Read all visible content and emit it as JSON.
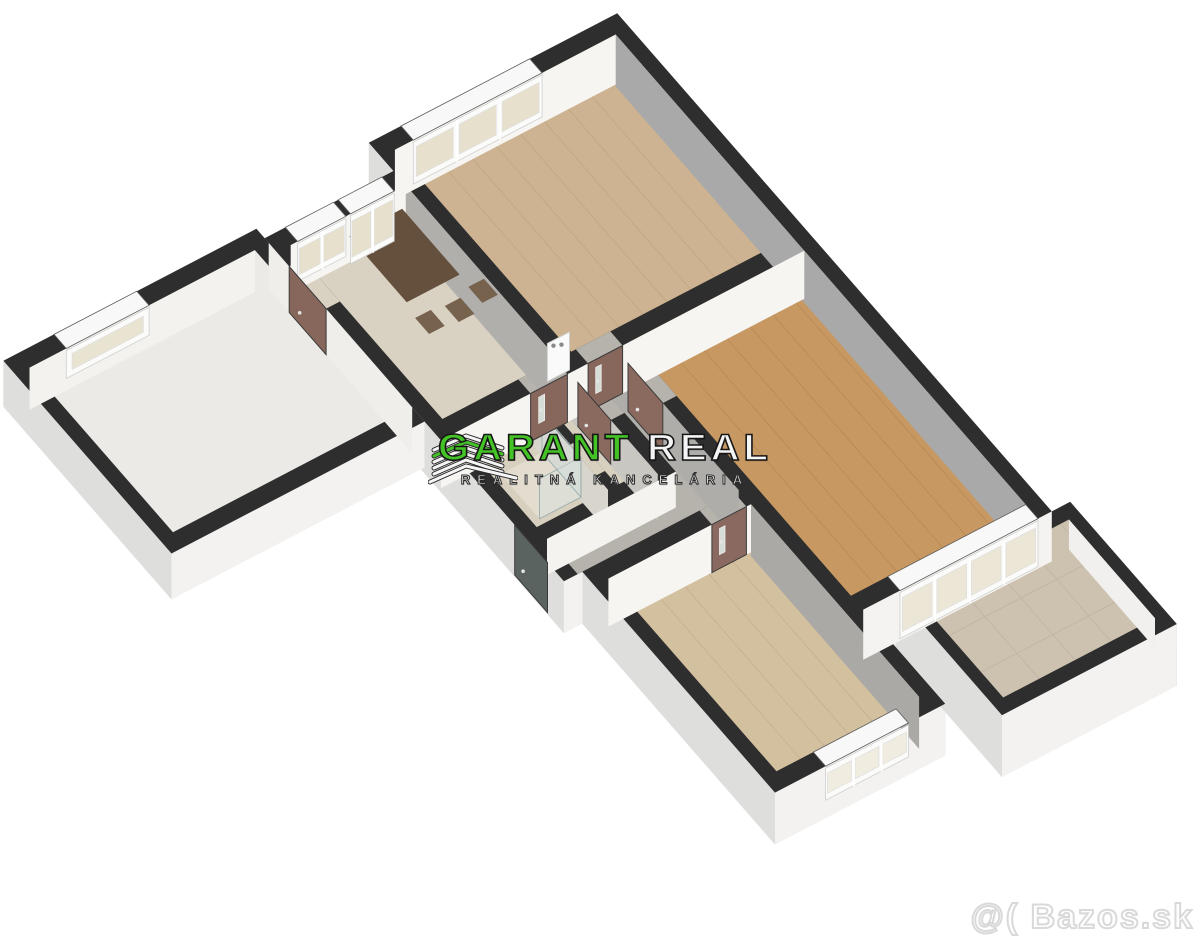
{
  "watermarks": {
    "logo_main": "GARANT",
    "logo_accent": "REAL",
    "logo_subtitle": "REALITNÁ KANCELÁRIA",
    "logo_green": "#44c327",
    "logo_white": "#f4f4f4",
    "portal_watermark": "@( Bazos.sk",
    "portal_watermark_color": "#d9d9d9"
  },
  "scene": {
    "type": "3d-floorplan-render",
    "background": "#ffffff",
    "rooms_semantic": [
      "loggia",
      "kitchen-dining",
      "bedroom-top",
      "living-room",
      "hallway",
      "bathroom",
      "wc",
      "bedroom-bottom",
      "balcony"
    ]
  },
  "plan": {
    "axon": {
      "ux": 46,
      "uy": -24,
      "vx": 41,
      "vy": 47,
      "ox": 240,
      "oy": 210,
      "wallH": 52
    },
    "colors": {
      "wall": "#2e2e2e",
      "bg": "#ffffff",
      "skirtDown": "#f3f2f0",
      "skirtLeft": "#dededd",
      "skirtRight": "#c6c6c6",
      "skirtUp": "#e9e9e8",
      "faceWhite": "#f6f5f2",
      "faceGray": "#a9a9a9"
    },
    "silhouettes": [
      {
        "name": "main-block",
        "h": 52,
        "pts": [
          [
            2.8,
            0
          ],
          [
            8.2,
            0
          ],
          [
            8.2,
            10.6
          ],
          [
            4.1,
            10.6
          ],
          [
            4.1,
            12.6
          ],
          [
            0.4,
            12.6
          ],
          [
            0.4,
            7.9
          ],
          [
            0,
            7.9
          ],
          [
            0,
            0.6
          ],
          [
            2.8,
            0.6
          ]
        ]
      },
      {
        "name": "loggia",
        "h": 46,
        "pts": [
          [
            -5.5,
            0.4
          ],
          [
            0,
            0.4
          ],
          [
            0,
            4.5
          ],
          [
            -5.5,
            4.5
          ]
        ]
      },
      {
        "name": "balcony",
        "h": 62,
        "pts": [
          [
            4.8,
            10.6
          ],
          [
            8.6,
            10.6
          ],
          [
            8.6,
            13.2
          ],
          [
            4.8,
            13.2
          ]
        ]
      }
    ],
    "floors": [
      {
        "name": "loggia-floor",
        "pts": [
          [
            -5.2,
            0.7
          ],
          [
            -0.3,
            0.7
          ],
          [
            -0.3,
            4.2
          ],
          [
            -5.2,
            4.2
          ]
        ],
        "fill": "#eceae6"
      },
      {
        "name": "kitchen-floor",
        "pts": [
          [
            0.3,
            0.9
          ],
          [
            2.8,
            0.9
          ],
          [
            2.8,
            4.6
          ],
          [
            0.3,
            4.6
          ]
        ],
        "fill": "#d9d1c2"
      },
      {
        "name": "bedroom-top-floor",
        "pts": [
          [
            3.1,
            0.3
          ],
          [
            7.9,
            0.3
          ],
          [
            7.9,
            4.6
          ],
          [
            3.1,
            4.6
          ]
        ],
        "fill": "#cdb391",
        "stripe": {
          "dir": "y",
          "gap": 0.52,
          "color": "#c2a884"
        }
      },
      {
        "name": "living-floor",
        "pts": [
          [
            4.1,
            4.9
          ],
          [
            7.9,
            4.9
          ],
          [
            7.9,
            10.3
          ],
          [
            4.1,
            10.3
          ]
        ],
        "fill": "#c79862",
        "stripe": {
          "dir": "y",
          "gap": 0.5,
          "color": "#bb8c55"
        }
      },
      {
        "name": "hall-floor",
        "pts": [
          [
            3.1,
            4.9
          ],
          [
            3.8,
            4.9
          ],
          [
            3.8,
            7.9
          ],
          [
            0.3,
            7.9
          ],
          [
            0.3,
            7.15
          ],
          [
            3.1,
            7.15
          ]
        ],
        "fill": "#b6b3ac"
      },
      {
        "name": "bathroom-floor",
        "pts": [
          [
            0.3,
            4.9
          ],
          [
            1.85,
            4.9
          ],
          [
            1.85,
            6.9
          ],
          [
            0.3,
            6.9
          ]
        ],
        "fill": "#d8d0bf"
      },
      {
        "name": "wc-floor",
        "pts": [
          [
            2.05,
            4.9
          ],
          [
            2.8,
            4.9
          ],
          [
            2.8,
            6.9
          ],
          [
            2.05,
            6.9
          ]
        ],
        "fill": "#d8d0bf"
      },
      {
        "name": "bedroom-bottom-floor",
        "pts": [
          [
            0.7,
            8.2
          ],
          [
            3.8,
            8.2
          ],
          [
            3.8,
            12.3
          ],
          [
            0.7,
            12.3
          ]
        ],
        "fill": "#d3c09e",
        "stripe": {
          "dir": "y",
          "gap": 0.52,
          "color": "#c8b391"
        }
      },
      {
        "name": "balcony-floor",
        "pts": [
          [
            5.05,
            10.85
          ],
          [
            8.35,
            10.85
          ],
          [
            8.35,
            12.95
          ],
          [
            5.05,
            12.95
          ]
        ],
        "fill": "#cdc2b0",
        "stripe": {
          "dir": "grid",
          "gap": 0.78,
          "color": "#c1b6a3"
        }
      }
    ],
    "bridges": [
      {
        "name": "kitchen-door-opening",
        "pts": [
          [
            1.95,
            4.6
          ],
          [
            2.75,
            4.6
          ],
          [
            2.75,
            4.9
          ],
          [
            1.95,
            4.9
          ]
        ],
        "fill": "#b6b3ac"
      },
      {
        "name": "bedroom-top-door-opening",
        "pts": [
          [
            3.2,
            4.6
          ],
          [
            3.95,
            4.6
          ],
          [
            3.95,
            4.9
          ],
          [
            3.2,
            4.9
          ]
        ],
        "fill": "#b6b3ac"
      },
      {
        "name": "living-door-opening",
        "pts": [
          [
            3.8,
            5.2
          ],
          [
            4.1,
            5.2
          ],
          [
            4.1,
            6.05
          ],
          [
            3.8,
            6.05
          ]
        ],
        "fill": "#b6b3ac"
      },
      {
        "name": "wc-door-opening",
        "pts": [
          [
            2.8,
            5.1
          ],
          [
            3.1,
            5.1
          ],
          [
            3.1,
            5.9
          ],
          [
            2.8,
            5.9
          ]
        ],
        "fill": "#b6b3ac"
      },
      {
        "name": "bath-door-opening",
        "pts": [
          [
            1.85,
            5.95
          ],
          [
            2.05,
            5.95
          ],
          [
            2.05,
            6.6
          ],
          [
            1.85,
            6.6
          ]
        ],
        "fill": "#d8d0bf"
      },
      {
        "name": "bedroom-bottom-door-opening",
        "pts": [
          [
            2.95,
            7.9
          ],
          [
            3.7,
            7.9
          ],
          [
            3.7,
            8.2
          ],
          [
            2.95,
            8.2
          ]
        ],
        "fill": "#b6b3ac"
      },
      {
        "name": "loggia-door-opening",
        "pts": [
          [
            -0.3,
            1.2
          ],
          [
            0.3,
            1.2
          ],
          [
            0.3,
            2.1
          ],
          [
            -0.3,
            2.1
          ]
        ],
        "fill": "#d9d1c2"
      }
    ],
    "faces": [
      {
        "a": [
          7.9,
          0.3
        ],
        "b": [
          7.9,
          10.3
        ],
        "h": 52,
        "fill": "#a9a9a9"
      },
      {
        "a": [
          2.8,
          0.9
        ],
        "b": [
          2.8,
          4.6
        ],
        "h": 52,
        "fill": "#b0afac"
      },
      {
        "a": [
          3.8,
          4.9
        ],
        "b": [
          3.8,
          7.9
        ],
        "h": 52,
        "fill": "#aeadaa"
      },
      {
        "a": [
          3.8,
          8.2
        ],
        "b": [
          3.8,
          12.3
        ],
        "h": 52,
        "fill": "#aaa9a6"
      },
      {
        "a": [
          2.8,
          4.9
        ],
        "b": [
          2.8,
          7.05
        ],
        "h": 46,
        "fill": "#c9c7c2"
      },
      {
        "a": [
          1.85,
          4.9
        ],
        "b": [
          1.85,
          6.9
        ],
        "h": 42,
        "fill": "#d8d5cd"
      },
      {
        "a": [
          0,
          0.7
        ],
        "b": [
          0,
          4.2
        ],
        "h": 46,
        "fill": "#efeeea"
      },
      {
        "a": [
          3.1,
          0.3
        ],
        "b": [
          7.9,
          0.3
        ],
        "h": 50,
        "fill": "#f6f5f2"
      },
      {
        "a": [
          0.3,
          0.9
        ],
        "b": [
          2.8,
          0.9
        ],
        "h": 48,
        "fill": "#f6f5f2"
      },
      {
        "a": [
          -5.2,
          0.7
        ],
        "b": [
          -0.3,
          0.7
        ],
        "h": 42,
        "fill": "#f3f2ef"
      },
      {
        "a": [
          0,
          4.9
        ],
        "b": [
          1.95,
          4.9
        ],
        "h": 48,
        "fill": "#f6f5f2"
      },
      {
        "a": [
          2.75,
          4.9
        ],
        "b": [
          3.2,
          4.9
        ],
        "h": 48,
        "fill": "#f6f5f2"
      },
      {
        "a": [
          3.95,
          4.9
        ],
        "b": [
          7.9,
          4.9
        ],
        "h": 48,
        "fill": "#f6f5f2"
      },
      {
        "a": [
          0.3,
          7.15
        ],
        "b": [
          3.1,
          7.15
        ],
        "h": 36,
        "fill": "#f4f3f0"
      },
      {
        "a": [
          0.7,
          8.2
        ],
        "b": [
          2.95,
          8.2
        ],
        "h": 48,
        "fill": "#f6f5f2"
      },
      {
        "a": [
          3.7,
          8.2
        ],
        "b": [
          3.8,
          8.2
        ],
        "h": 48,
        "fill": "#f6f5f2"
      },
      {
        "a": [
          4.1,
          10.6
        ],
        "b": [
          8.2,
          10.6
        ],
        "h": 50,
        "fill": "#f4f3f1"
      },
      {
        "a": [
          8.35,
          10.85
        ],
        "b": [
          8.35,
          12.95
        ],
        "h": 30,
        "fill": "#f1f0ee"
      }
    ],
    "windows": [
      {
        "name": "bedroom-top-window",
        "a": [
          3.5,
          0
        ],
        "b": [
          6.3,
          0
        ],
        "band": [
          [
            3.5,
            0
          ],
          [
            6.3,
            0
          ],
          [
            6.3,
            0.3
          ],
          [
            3.5,
            0.3
          ]
        ],
        "faceA": [
          3.5,
          0.3
        ],
        "faceB": [
          6.3,
          0.3
        ],
        "panes": 3,
        "h": 44,
        "glass": "#e7e0cd"
      },
      {
        "name": "kitchen-window",
        "a": [
          0.45,
          0.6
        ],
        "b": [
          1.5,
          0.6
        ],
        "band": [
          [
            0.45,
            0.6
          ],
          [
            1.5,
            0.6
          ],
          [
            1.5,
            0.9
          ],
          [
            0.45,
            0.9
          ]
        ],
        "faceA": [
          0.45,
          0.9
        ],
        "faceB": [
          1.5,
          0.9
        ],
        "panes": 2,
        "h": 40,
        "glass": "#e7e0cd"
      },
      {
        "name": "kitchen-balcony-door",
        "a": [
          1.6,
          0.6
        ],
        "b": [
          2.55,
          0.6
        ],
        "band": [
          [
            1.6,
            0.6
          ],
          [
            2.55,
            0.6
          ],
          [
            2.55,
            0.9
          ],
          [
            1.6,
            0.9
          ]
        ],
        "faceA": [
          1.6,
          0.9
        ],
        "faceB": [
          2.55,
          0.9
        ],
        "panes": 2,
        "h": 50,
        "glass": "#e7e0cd"
      },
      {
        "name": "loggia-window",
        "a": [
          -4.4,
          0.4
        ],
        "b": [
          -2.6,
          0.4
        ],
        "band": [
          [
            -4.4,
            0.4
          ],
          [
            -2.6,
            0.4
          ],
          [
            -2.6,
            0.7
          ],
          [
            -4.4,
            0.7
          ]
        ],
        "faceA": [
          -4.4,
          0.7
        ],
        "faceB": [
          -2.6,
          0.7
        ],
        "panes": 1,
        "h": 30,
        "glass": "#e9e3d2"
      },
      {
        "name": "living-balcony-window",
        "a": [
          4.9,
          10.3
        ],
        "b": [
          7.9,
          10.3
        ],
        "band": [
          [
            4.9,
            10.3
          ],
          [
            7.9,
            10.3
          ],
          [
            7.9,
            10.6
          ],
          [
            4.9,
            10.6
          ]
        ],
        "faceA": [
          4.9,
          10.6
        ],
        "faceB": [
          7.9,
          10.6
        ],
        "panes": 4,
        "h": 48,
        "glass": "#ece6d6"
      },
      {
        "name": "bedroom-bottom-window",
        "a": [
          1.5,
          12.3
        ],
        "b": [
          3.3,
          12.3
        ],
        "band": [
          [
            1.5,
            12.3
          ],
          [
            3.3,
            12.3
          ],
          [
            3.3,
            12.6
          ],
          [
            1.5,
            12.6
          ]
        ],
        "faceA": [
          1.5,
          12.6
        ],
        "faceB": [
          3.3,
          12.6
        ],
        "panes": 3,
        "h": 34,
        "glass": "#f0ece0"
      }
    ],
    "doors": [
      {
        "name": "loggia-door",
        "a": [
          0,
          1.2
        ],
        "b": [
          0,
          2.1
        ],
        "h": 46,
        "fill": "#87665b",
        "glass": false
      },
      {
        "name": "kitchen-door",
        "a": [
          1.95,
          4.9
        ],
        "b": [
          2.75,
          4.9
        ],
        "h": 48,
        "fill": "#87665b",
        "glass": true
      },
      {
        "name": "bedroom-top-door",
        "a": [
          3.2,
          4.9
        ],
        "b": [
          3.95,
          4.9
        ],
        "h": 48,
        "fill": "#87665b",
        "glass": true
      },
      {
        "name": "living-room-door",
        "a": [
          3.8,
          5.2
        ],
        "b": [
          3.8,
          6.05
        ],
        "h": 48,
        "fill": "#8a695e",
        "glass": false
      },
      {
        "name": "wc-door",
        "a": [
          2.8,
          5.1
        ],
        "b": [
          2.8,
          5.9
        ],
        "h": 44,
        "fill": "#8a695e",
        "glass": false
      },
      {
        "name": "bedroom-bottom-door",
        "a": [
          2.95,
          8.2
        ],
        "b": [
          3.7,
          8.2
        ],
        "h": 48,
        "fill": "#8a6a60",
        "glass": true
      },
      {
        "name": "entrance-door",
        "a": [
          0,
          6.7
        ],
        "b": [
          0,
          7.5
        ],
        "h": 50,
        "fill": "#5a6360",
        "glass": false
      }
    ],
    "furniture": {
      "table": {
        "pts": [
          [
            0.95,
            1.6
          ],
          [
            2.1,
            1.6
          ],
          [
            2.1,
            3.0
          ],
          [
            0.95,
            3.0
          ]
        ],
        "lift": 26,
        "fill": "#64503c"
      },
      "chairs": [
        {
          "x": 1.0,
          "y": 3.15
        },
        {
          "x": 1.6,
          "y": 3.2
        },
        {
          "x": 2.2,
          "y": 3.1
        }
      ],
      "chairSize": 0.34,
      "chairLift": 16,
      "chairFill": "#77624e",
      "showerTray": {
        "pts": [
          [
            0.45,
            5.85
          ],
          [
            1.35,
            5.85
          ],
          [
            1.35,
            6.8
          ],
          [
            0.45,
            6.8
          ]
        ],
        "fill": "#e3ddcf"
      },
      "showerGlassH": 40,
      "boiler": {
        "a": [
          2.28,
          4.94
        ],
        "b": [
          2.76,
          4.94
        ],
        "top": 44,
        "bottom": 6,
        "fill": "#fafafa"
      }
    }
  }
}
